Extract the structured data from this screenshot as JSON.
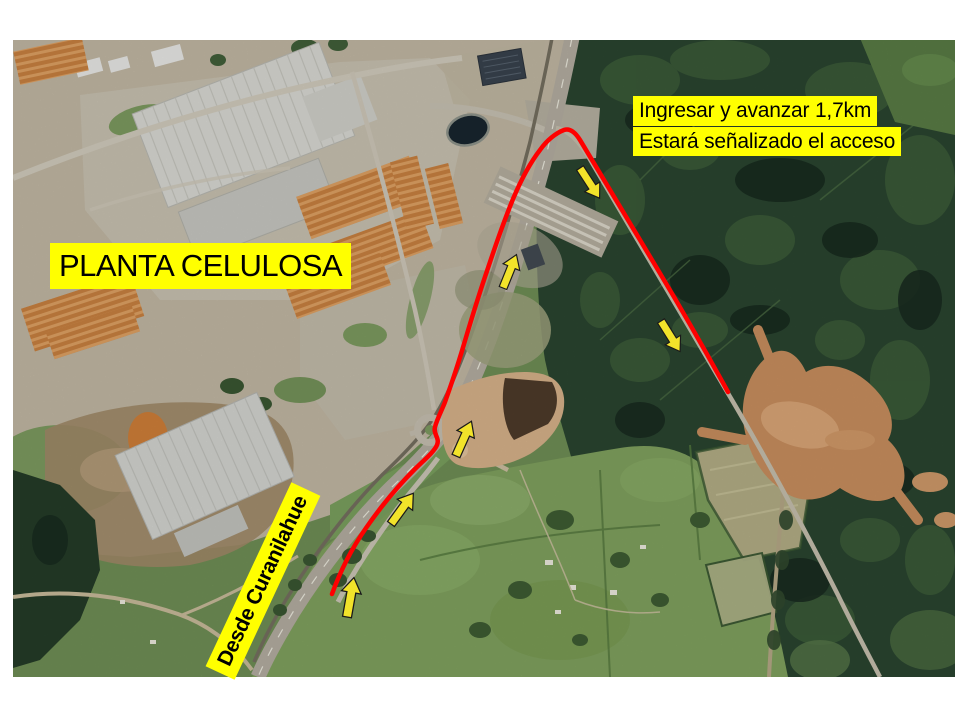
{
  "map": {
    "type": "satellite-route-map",
    "plant_label": "PLANTA CELULOSA",
    "instructions": {
      "line1": "Ingresar y avanzar 1,7km",
      "line2": "Estará señalizado el acceso"
    },
    "origin_label": "Desde Curanilahue",
    "route": {
      "color": "#FF0000",
      "arrow_color": "#F2E32A",
      "arrow_count": 6
    },
    "colors": {
      "label_highlight": "#FFFF00",
      "label_text": "#000000",
      "slide_background": "#FFFFFF"
    }
  }
}
